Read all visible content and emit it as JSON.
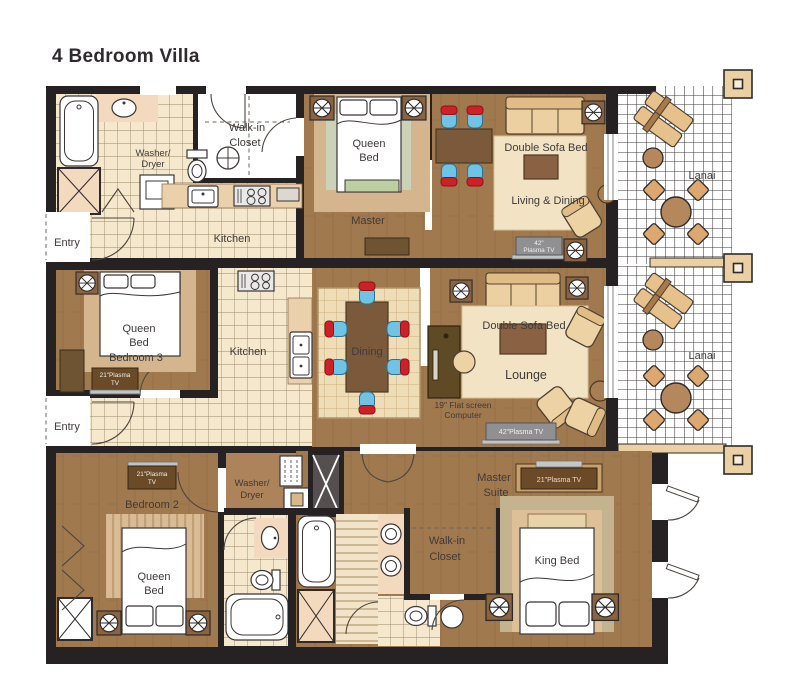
{
  "title": "4 Bedroom Villa",
  "palette": {
    "wall": "#262223",
    "wood": "#a1794f",
    "tile": "#f6e8cc",
    "fixture_pink": "#f3d9bd",
    "rug_tan": "#d5b58e",
    "sofa_tan": "#ecd0a2",
    "table_brown": "#7b5a3c",
    "chair_blue": "#6fc4e6",
    "chair_red": "#cd2027",
    "tv_gray": "#909092",
    "tv_brown": "#6b4a28",
    "desk_olive": "#5e4a24",
    "label_text": "#3e3a39"
  },
  "u1": {
    "washer_dryer_l1": "Washer/",
    "washer_dryer_l2": "Dryer",
    "walkin_l1": "Walk-in",
    "walkin_l2": "Closet",
    "kitchen": "Kitchen",
    "entry": "Entry",
    "bed_l1": "Queen",
    "bed_l2": "Bed",
    "room": "Master",
    "sofa": "Double Sofa Bed",
    "living": "Living & Dining",
    "tv_l1": "42\"",
    "tv_l2": "Plasma TV",
    "lanai": "Lanai"
  },
  "u2": {
    "bed_l1": "Queen",
    "bed_l2": "Bed",
    "room": "Bedroom 3",
    "tv_l1": "21\"Plasma",
    "tv_l2": "TV",
    "kitchen": "Kitchen",
    "entry": "Entry",
    "dining": "Dining",
    "sofa": "Double Sofa Bed",
    "lounge": "Lounge",
    "computer_l1": "19\" Flat screen",
    "computer_l2": "Computer",
    "tv_main": "42\"Plasma TV",
    "lanai": "Lanai"
  },
  "u3": {
    "tv_l1": "21\"Plasma",
    "tv_l2": "TV",
    "room": "Bedroom 2",
    "bed_l1": "Queen",
    "bed_l2": "Bed",
    "washer_dryer_l1": "Washer/",
    "washer_dryer_l2": "Dryer",
    "walkin_l1": "Walk-in",
    "walkin_l2": "Closet",
    "suite_l1": "Master",
    "suite_l2": "Suite",
    "tv_master": "21\"Plasma TV",
    "king": "King Bed"
  }
}
